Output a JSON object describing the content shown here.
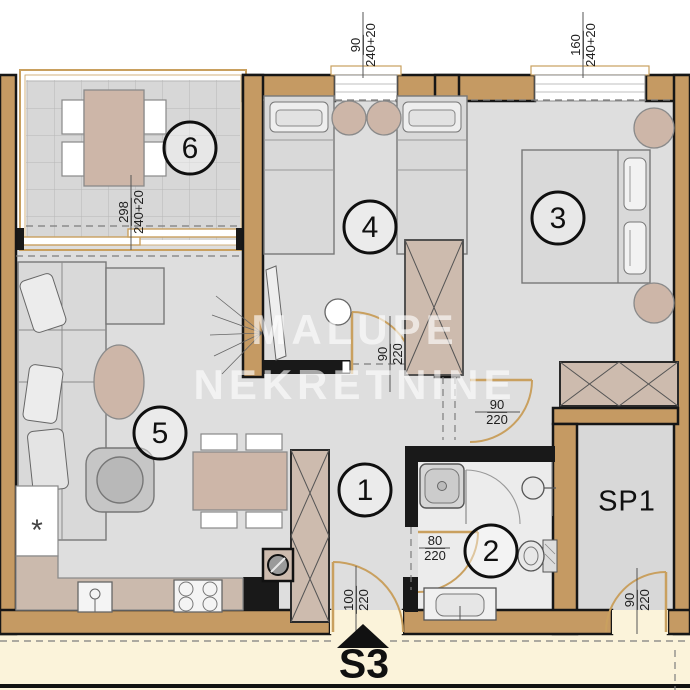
{
  "watermark": {
    "line1": "MALUPE",
    "line2": "NEKRETNINE"
  },
  "labels": {
    "storage": "SP1",
    "entrance_mark": "S3",
    "fridge_symbol": "*"
  },
  "rooms": [
    {
      "number": "1",
      "name": "hallway"
    },
    {
      "number": "2",
      "name": "bathroom"
    },
    {
      "number": "3",
      "name": "bedroom-1"
    },
    {
      "number": "4",
      "name": "bedroom-2"
    },
    {
      "number": "5",
      "name": "living-room-kitchen"
    },
    {
      "number": "6",
      "name": "balcony"
    }
  ],
  "dimensions": [
    {
      "id": "window-room4",
      "top": "90",
      "bottom": "240+20"
    },
    {
      "id": "window-room3",
      "top": "160",
      "bottom": "240+20"
    },
    {
      "id": "balcony-opening",
      "top": "298",
      "bottom": "240+20"
    },
    {
      "id": "door-room4",
      "top": "90",
      "bottom": "220"
    },
    {
      "id": "door-room3",
      "top": "90",
      "bottom": "220"
    },
    {
      "id": "door-bathroom",
      "top": "80",
      "bottom": "220"
    },
    {
      "id": "door-entrance",
      "top": "100",
      "bottom": "220"
    },
    {
      "id": "door-sp1",
      "top": "90",
      "bottom": "220"
    }
  ],
  "colors": {
    "wall": "#c59a63",
    "floor": "#dedede",
    "outside": "#fbf3da",
    "door_arc": "#c9a05f",
    "furniture_tan": "#cdb6a8",
    "line": "#161616"
  }
}
